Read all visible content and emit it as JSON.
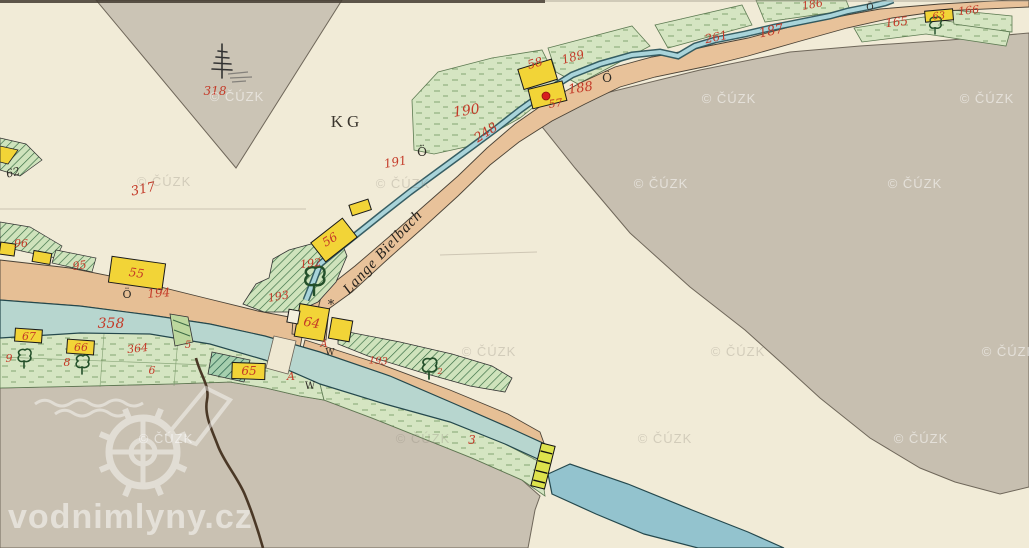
{
  "watermarks": {
    "cuzk": "© ČÚZK",
    "site": "vodnimlyny.cz"
  },
  "map_labels": {
    "kg": "KG",
    "stream_name": "Lange Bielbach",
    "n318": "318",
    "n317": "317",
    "t62": "62",
    "n96": "96",
    "n95": "95",
    "n194": "194",
    "n358": "358",
    "n364": "364",
    "n5": "5",
    "n6": "6",
    "n9": "9",
    "n8": "8",
    "n192": "192",
    "n193": "193",
    "n248": "248",
    "n190": "190",
    "n191": "191",
    "n188": "188",
    "n189": "189",
    "n261": "261",
    "n187": "187",
    "n186": "186",
    "n165": "165",
    "n166": "166",
    "n2": "2",
    "n3": "3",
    "h55": "55",
    "h56": "56",
    "h57": "57",
    "h58": "58",
    "h63": "63",
    "h64": "64",
    "h65": "65",
    "h66": "66",
    "h67": "67",
    "oe": "Ö",
    "a": "A",
    "w": "W",
    "star": "*"
  },
  "colors": {
    "paper_cream": "#f1ebd7",
    "field_gray": "#c7bfb0",
    "road_tan": "#e6bf95",
    "water_channel": "#b7d6cf",
    "water_stream": "#a9d4da",
    "meadow_green": "#d5e5c2",
    "hatched_meadow": "#cfe3bc",
    "building_yellow": "#f2d437",
    "parcel_number_red": "#c43a28",
    "mill_dot_red": "#d81f1f",
    "weir_yellow_green": "#dde24c"
  }
}
